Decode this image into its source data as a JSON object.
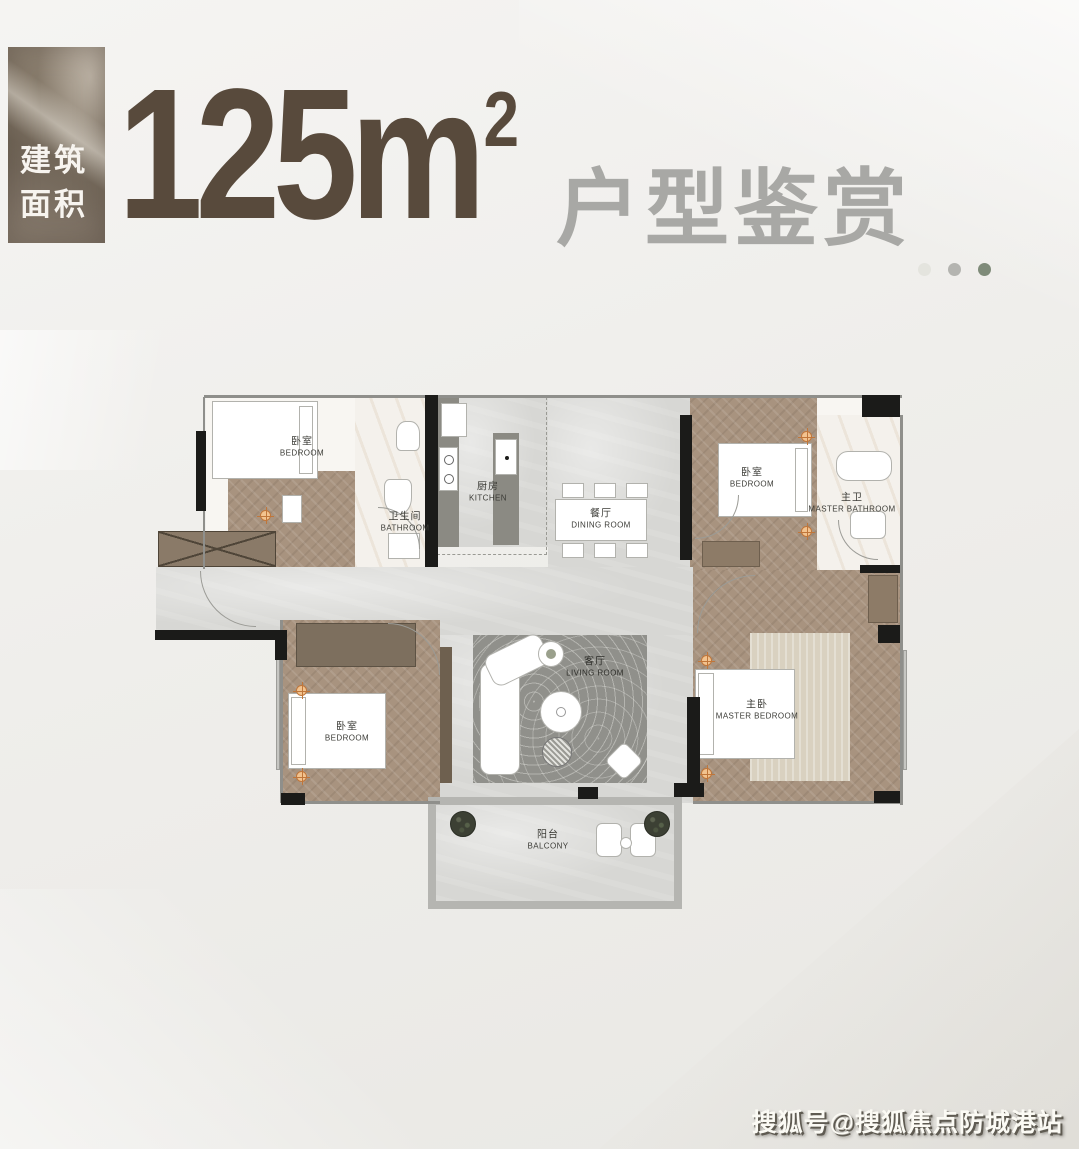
{
  "header": {
    "badge": {
      "line1": "建筑",
      "line2": "面积"
    },
    "area": {
      "value": "125",
      "unit": "m",
      "exponent": "2"
    },
    "title": "户型鉴赏",
    "dot_colors": [
      "#e4e4de",
      "#b4b4b0",
      "#7f8b79"
    ],
    "dot_styles": [
      "background:#e4e4de",
      "background:#b4b4b0",
      "background:#7f8b79"
    ]
  },
  "floorplan": {
    "rooms": {
      "bedroom_top_left": {
        "cn": "卧室",
        "en": "BEDROOM"
      },
      "bathroom": {
        "cn": "卫生间",
        "en": "BATHROOM"
      },
      "kitchen": {
        "cn": "厨房",
        "en": "KITCHEN"
      },
      "dining": {
        "cn": "餐厅",
        "en": "DINING ROOM"
      },
      "bedroom_top_right": {
        "cn": "卧室",
        "en": "BEDROOM"
      },
      "master_bathroom": {
        "cn": "主卫",
        "en": "MASTER BATHROOM"
      },
      "bedroom_bottom_left": {
        "cn": "卧室",
        "en": "BEDROOM"
      },
      "living": {
        "cn": "客厅",
        "en": "LIVING ROOM"
      },
      "master_bedroom": {
        "cn": "主卧",
        "en": "MASTER BEDROOM"
      },
      "balcony": {
        "cn": "阳台",
        "en": "BALCONY"
      }
    }
  },
  "watermark": "搜狐号@搜狐焦点防城港站",
  "colors": {
    "accent_brown": "#584a3c",
    "title_gray": "#a8a8a5",
    "wood_floor": "#a8937f",
    "gray_floor": "#d7d7d4",
    "rug_gray": "#90908b",
    "wall_black": "#1b1b19",
    "downlight_orange": "#c0763a"
  }
}
